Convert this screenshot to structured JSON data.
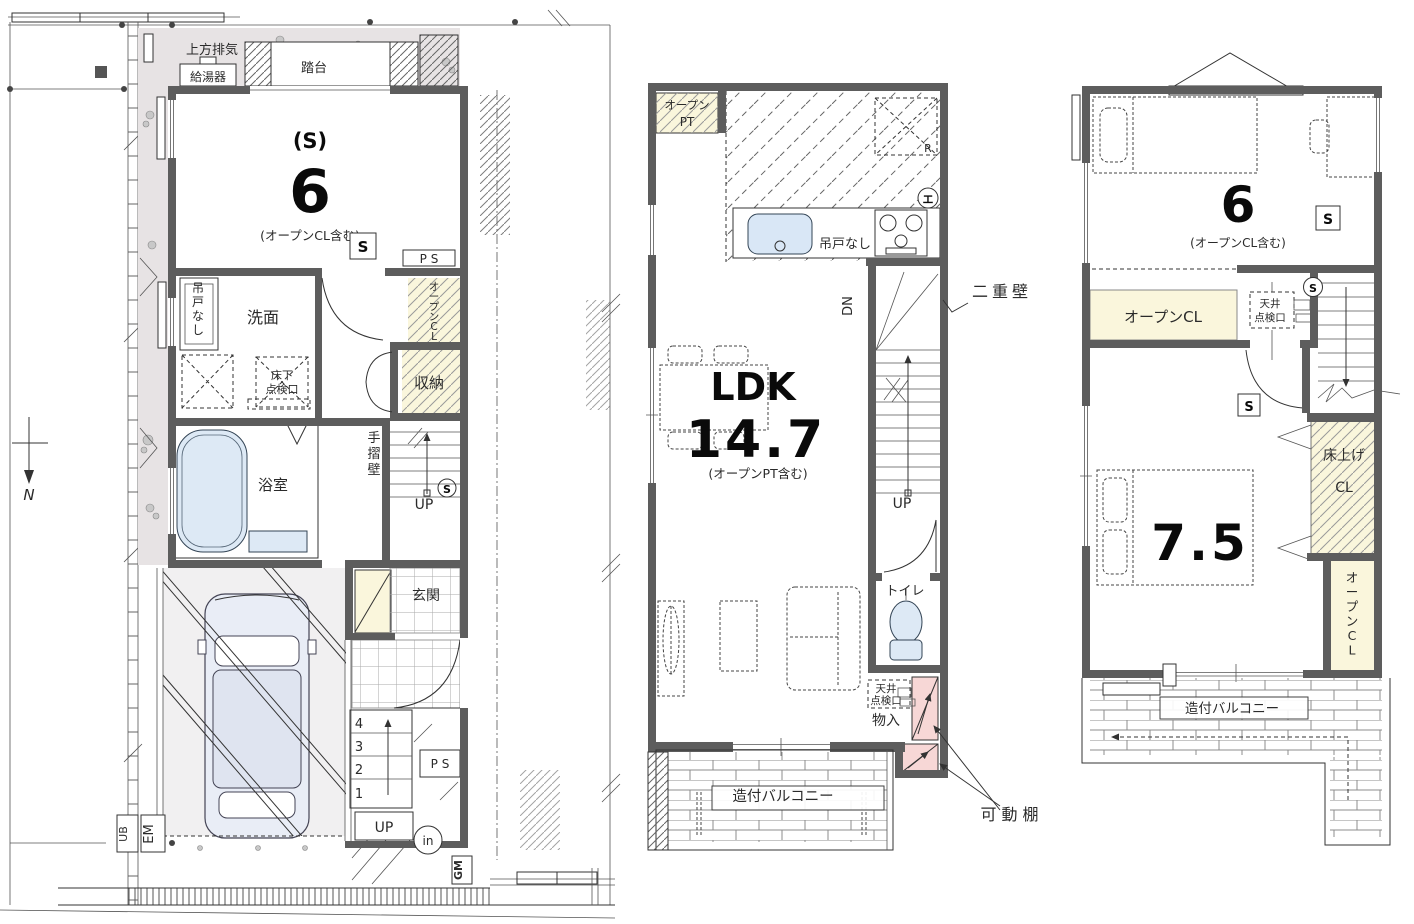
{
  "doc": {
    "kind": "floor-plan-drawing",
    "floors_shown": 3
  },
  "colors": {
    "wall": "#5d5d5d",
    "yard_gray": "#e7e3e4",
    "closet_cream": "#faf6dc",
    "water_blue": "#dde9f5",
    "shelf_pink": "#f7d7d6",
    "garage_gray": "#f1f0f1",
    "gm_text": "#9a5a1a"
  },
  "f1": {
    "north": "N",
    "exhaust": "上方排気",
    "water_heater": "給湯器",
    "step_platform": "踏台",
    "room_mark": "(S)",
    "room_area": "6",
    "room_note": "(オープンCL含む)",
    "s_symbol": "S",
    "ps": "P S",
    "open_cl_vertical": "オープンCL",
    "no_hanging_door": "吊戸なし",
    "washroom": "洗面",
    "underfloor_1": "床下",
    "underfloor_2": "点検口",
    "storage": "収納",
    "bathroom": "浴室",
    "handrail_wall": "手摺壁",
    "up": "UP",
    "smoke_s": "S",
    "entrance": "玄関",
    "steps": [
      "4",
      "3",
      "2",
      "1"
    ],
    "ps2": "P S",
    "up_outdoor": "UP",
    "intercom": "in",
    "gas_meter": "GM",
    "electric_meter": "EM",
    "unit_bath": "UB"
  },
  "f2": {
    "open_pt_1": "オープン",
    "open_pt_2": "PT",
    "fridge": "R",
    "no_hanging_door": "吊戸なし",
    "heat_symbol": "エ",
    "dn": "DN",
    "double_wall": "二重壁",
    "ldk": "LDK",
    "ldk_area": "14.7",
    "ldk_note": "(オープンPT含む)",
    "up": "UP",
    "toilet": "トイレ",
    "ceiling_1": "天井",
    "ceiling_2": "点検口",
    "closet": "物入",
    "movable_shelf": "可動棚",
    "balcony": "造付バルコニー"
  },
  "f3": {
    "room_area": "6",
    "room_note": "(オープンCL含む)",
    "s_symbol": "S",
    "open_cl": "オープンCL",
    "ceiling_1": "天井",
    "ceiling_2": "点検口",
    "smoke_s": "S",
    "room2_area": "7.5",
    "s_symbol2": "S",
    "raised_1": "床上げ",
    "raised_2": "CL",
    "open_cl_vertical": "オープンCL",
    "balcony": "造付バルコニー"
  }
}
